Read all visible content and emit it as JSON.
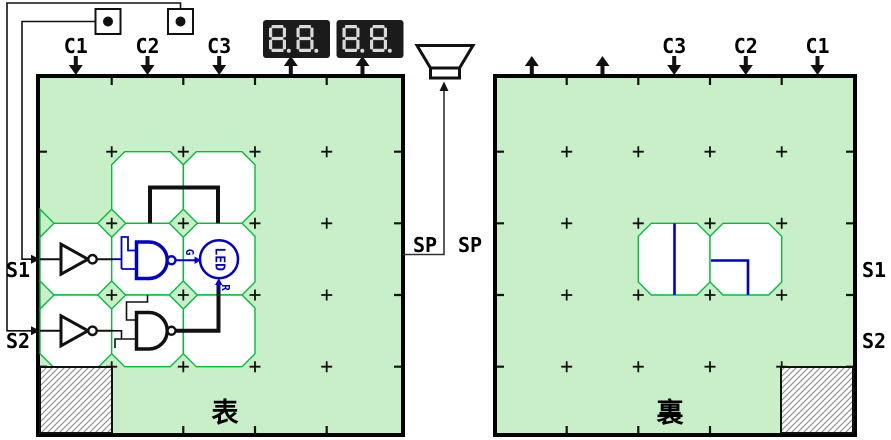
{
  "front_board": {
    "title": "表",
    "column_inputs": [
      "C1",
      "C2",
      "C3"
    ],
    "row_inputs": [
      "S1",
      "S2"
    ],
    "speaker_label": "SP"
  },
  "back_board": {
    "title": "裏",
    "column_inputs": [
      "C3",
      "C2",
      "C1"
    ],
    "row_labels": [
      "S1",
      "S2"
    ],
    "speaker_label": "SP"
  },
  "displays": [
    {
      "value": "8.8."
    },
    {
      "value": "8.8."
    }
  ],
  "led": {
    "label": "LED",
    "green_input": "G",
    "red_input": "R"
  },
  "colors": {
    "board_bg": "#c8efc8",
    "cell_stroke": "#00bf3a",
    "wire_blue": "#0000cc",
    "display_bg": "#1b1b1b",
    "segment_on": "#d9d9d9"
  }
}
